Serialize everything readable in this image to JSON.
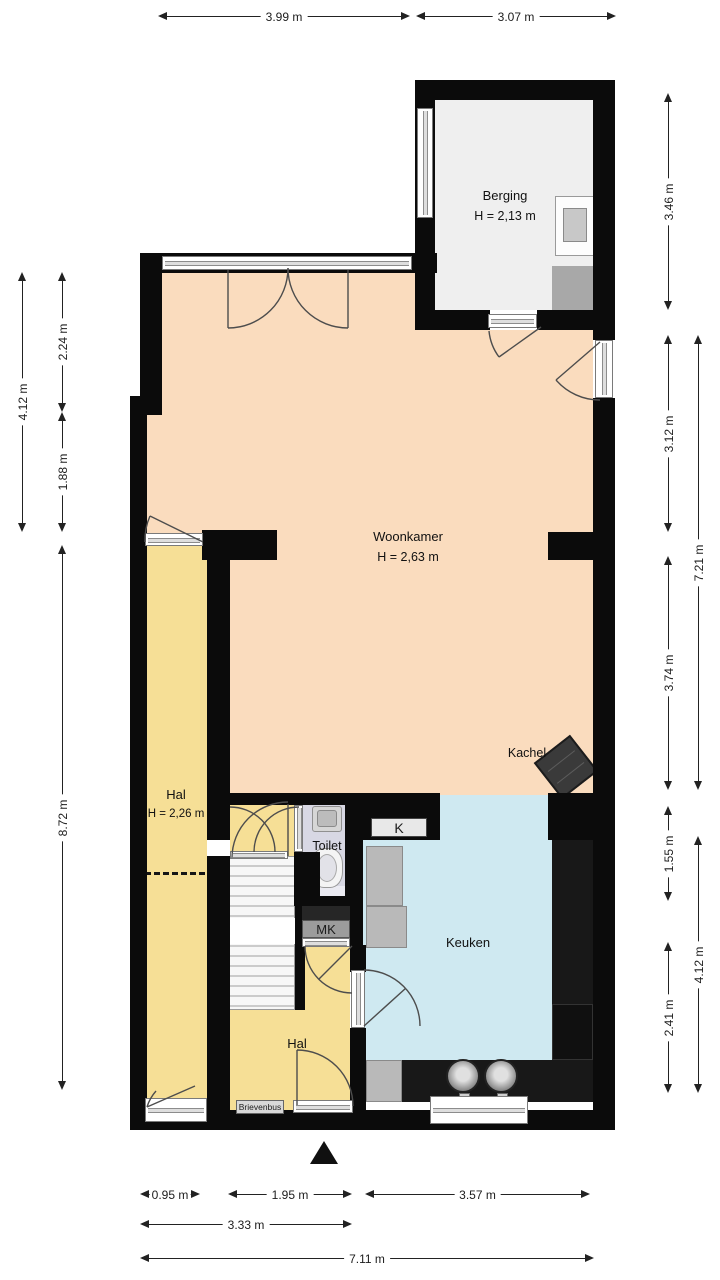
{
  "plan_type": "floorplan",
  "colors": {
    "wall": "#0b0b0b",
    "woonkamer_floor": "#fadcbe",
    "hal_floor": "#f6df96",
    "keuken_floor": "#cfe9f1",
    "toilet_floor": "#d8d8e4",
    "berging_floor": "#efefef",
    "counter_dark": "#181818",
    "counter_gray": "#b9b9b9"
  },
  "rooms": {
    "berging": {
      "name": "Berging",
      "height": "H = 2,13 m"
    },
    "woonkamer": {
      "name": "Woonkamer",
      "height": "H = 2,63 m"
    },
    "hal": {
      "name": "Hal",
      "height": "H = 2,26 m"
    },
    "toilet": {
      "name": "Toilet"
    },
    "keuken": {
      "name": "Keuken"
    },
    "hal2": {
      "name": "Hal"
    }
  },
  "labels": {
    "kachel": "Kachel",
    "mk": "MK",
    "k": "K",
    "brievenbus": "Brievenbus"
  },
  "dims": {
    "top": [
      "3.99 m",
      "3.07 m"
    ],
    "left": [
      "4.12 m",
      "2.24 m",
      "1.88 m",
      "8.72 m"
    ],
    "right": [
      "3.46 m",
      "3.12 m",
      "3.74 m",
      "1.55 m",
      "2.41 m",
      "7.21 m",
      "4.12 m"
    ],
    "bottom": [
      "0.95 m",
      "1.95 m",
      "3.57 m",
      "3.33 m",
      "7.11 m"
    ]
  }
}
